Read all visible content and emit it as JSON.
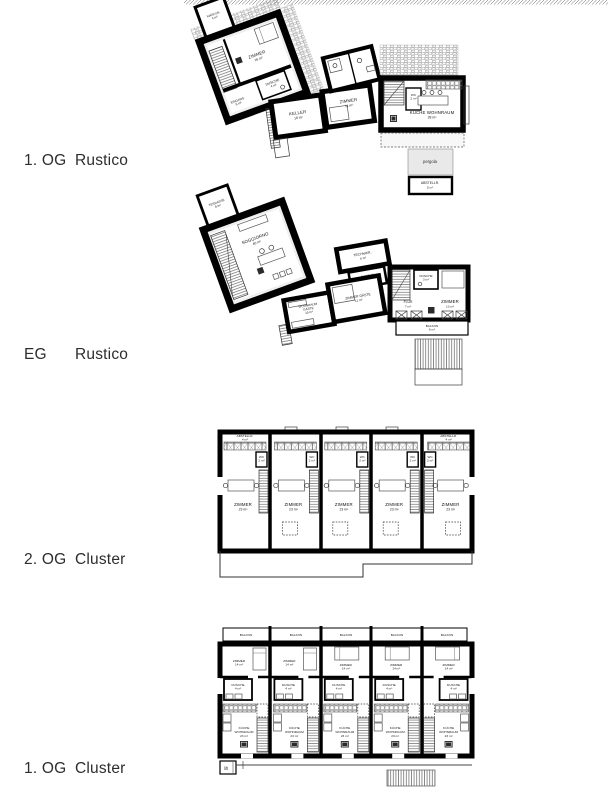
{
  "page": {
    "background": "#ffffff",
    "ink": "#000000",
    "room_fill": "#efefef"
  },
  "floor_labels": [
    {
      "level": "1. OG",
      "name": "Rustico"
    },
    {
      "level": "EG",
      "name": "Rustico"
    },
    {
      "level": "2. OG",
      "name": "Cluster"
    },
    {
      "level": "1. OG",
      "name": "Cluster"
    }
  ],
  "plans": {
    "og1_rustico": {
      "rooms": {
        "waschk": {
          "label": "WASCHK.",
          "area": "4 m²"
        },
        "zimmer": {
          "label": "ZIMMER",
          "area": "16 m²"
        },
        "dusche": {
          "label": "DUSCHE",
          "area": "4 m²"
        },
        "eingang": {
          "label": "EINGANG",
          "area": "6 m²"
        },
        "keller": {
          "label": "KELLER",
          "area": "18 m²"
        },
        "zimmer2": {
          "label": "ZIMMER",
          "area": "11 m²"
        },
        "wc": {
          "label": "WC",
          "area": "2 m²"
        },
        "kueche_wohnraum": {
          "label": "KÜCHE WOHNRAUM",
          "area": "28 m²"
        },
        "pergola": {
          "label": "pergola"
        },
        "abstellr": {
          "label": "ABSTELLR.",
          "area": "5 m²"
        }
      }
    },
    "eg_rustico": {
      "rooms": {
        "terrasse": {
          "label": "TERRASSE",
          "area": "8 m²"
        },
        "soggiorno": {
          "label": "SOGGIORNO",
          "area": "40 m²"
        },
        "technikr": {
          "label": "TECHNIKR.",
          "area": "6 m²"
        },
        "dusche_top": {
          "label": "DUSCHE",
          "area": "5 m²"
        },
        "wohnraum_gaeste": {
          "line1": "WOHNRAUM",
          "line2": "GÄSTE",
          "area": "10 m²"
        },
        "zimmer_gaeste": {
          "label": "ZIMMER GÄSTE",
          "area": "11 m²"
        },
        "dusche": {
          "label": "DUSCHE",
          "area": "3 m²"
        },
        "flur": {
          "label": "FLUR",
          "area": "7 m²"
        },
        "zimmer": {
          "label": "ZIMMER",
          "area": "13 m²"
        },
        "balkon": {
          "label": "BALKON",
          "area": "6 m²"
        }
      }
    },
    "og2_cluster": {
      "abstellr_left": {
        "label": "ABSTELLR.",
        "area": "4 m²"
      },
      "abstellr_right": {
        "label": "ABSTELLR.",
        "area": "4 m²"
      },
      "units": [
        {
          "wc": "WC",
          "wc_area": "2 m²",
          "zimmer": "ZIMMER",
          "zimmer_area": "23 m²"
        },
        {
          "wc": "WC",
          "wc_area": "2 m²",
          "zimmer": "ZIMMER",
          "zimmer_area": "23 m²"
        },
        {
          "wc": "WC",
          "wc_area": "2 m²",
          "zimmer": "ZIMMER",
          "zimmer_area": "23 m²"
        },
        {
          "wc": "WC",
          "wc_area": "2 m²",
          "zimmer": "ZIMMER",
          "zimmer_area": "23 m²"
        },
        {
          "wc": "WC",
          "wc_area": "2 m²",
          "zimmer": "ZIMMER",
          "zimmer_area": "23 m²"
        }
      ]
    },
    "og1_cluster": {
      "lift": "lift",
      "units": [
        {
          "balkon": "BALKON",
          "zimmer": "ZIMMER",
          "zimmer_area": "14 m²",
          "dusche": "DUSCHE",
          "dusche_area": "4 m²",
          "kueche_line1": "KÜCHE",
          "kueche_line2": "WOHNRAUM",
          "kueche_area": "23 m²"
        },
        {
          "balkon": "BALKON",
          "zimmer": "ZIMMER",
          "zimmer_area": "14 m²",
          "dusche": "DUSCHE",
          "dusche_area": "4 m²",
          "kueche_line1": "KÜCHE",
          "kueche_line2": "WOHNRAUM",
          "kueche_area": "23 m²"
        },
        {
          "balkon": "BALKON",
          "zimmer": "ZIMMER",
          "zimmer_area": "14 m²",
          "dusche": "DUSCHE",
          "dusche_area": "4 m²",
          "kueche_line1": "KÜCHE",
          "kueche_line2": "WOHNRAUM",
          "kueche_area": "23 m²"
        },
        {
          "balkon": "BALKON",
          "zimmer": "ZIMMER",
          "zimmer_area": "14 m²",
          "dusche": "DUSCHE",
          "dusche_area": "4 m²",
          "kueche_line1": "KÜCHE",
          "kueche_line2": "WOHNRAUM",
          "kueche_area": "23 m²"
        },
        {
          "balkon": "BALKON",
          "zimmer": "ZIMMER",
          "zimmer_area": "14 m²",
          "dusche": "DUSCHE",
          "dusche_area": "4 m²",
          "kueche_line1": "KÜCHE",
          "kueche_line2": "WOHNRAUM",
          "kueche_area": "23 m²"
        }
      ]
    }
  }
}
